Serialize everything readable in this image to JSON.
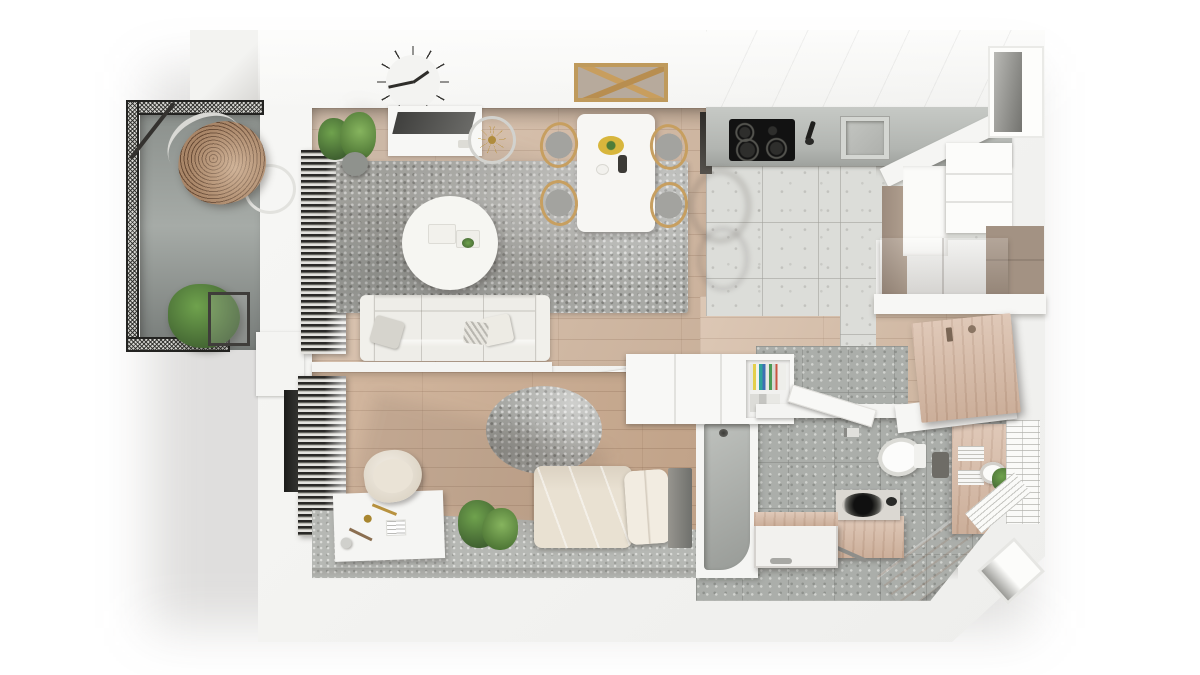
{
  "scene": {
    "title": "apartment-floor-plan-3d-render-top-view",
    "style": "photorealistic rendered floor plan, top-down, no visible text"
  },
  "palette": {
    "wall": "#f3f3f1",
    "wood": "#d6bda7",
    "wood2": "#cdae93",
    "woodfurn": "#d9bda9",
    "tile": "#dcddd9",
    "concrete": "#abaeaa",
    "carpet": "#b6b8b4",
    "rug": "#a8a9a5",
    "mesh": "#2b2b28",
    "taupe": "#a79685",
    "sofa": "#eeede8",
    "bedding": "#e9e1d2",
    "green": "#4f7d39",
    "gold": "#bf9a3f",
    "yellow": "#d8b63c",
    "dark": "#181816"
  },
  "rooms": [
    {
      "name": "balcony",
      "furniture": [
        "mesh railing",
        "hanging egg chair",
        "potted plant",
        "wire side table"
      ]
    },
    {
      "name": "living room",
      "furniture": [
        "wall clock",
        "tv console",
        "floor lamp",
        "potted plants",
        "shag rug",
        "round coffee table",
        "3-seat sofa",
        "window blinds with radiator"
      ]
    },
    {
      "name": "dining area",
      "furniture": [
        "white dining table",
        "4 wooden hoop chairs",
        "wooden pendant frame",
        "yellow plate",
        "dark bottle"
      ]
    },
    {
      "name": "kitchen",
      "furniture": [
        "gray countertop",
        "black induction cooktop",
        "sink with black faucet",
        "tall white cabinets",
        "taupe cabinets",
        "white shelf",
        "speckled tile floor",
        "wall niche"
      ]
    },
    {
      "name": "entry hall",
      "furniture": [
        "wooden entry door",
        "white console shelf",
        "wood floor"
      ]
    },
    {
      "name": "bathroom",
      "furniture": [
        "walk-in shower with drain",
        "wall-hung toilet",
        "toilet paper holder",
        "wood-clad washing machine",
        "white storage bench",
        "wood vanity with round basin",
        "towel shelves",
        "white wall tiles",
        "wall niche",
        "plant"
      ]
    },
    {
      "name": "bedroom",
      "furniture": [
        "single bed with cream duvet",
        "pillow",
        "dark headboard",
        "round shag rug",
        "white desk with lamp",
        "cream tub armchair",
        "potted plant",
        "window blinds",
        "gray carpet strip"
      ]
    },
    {
      "name": "hallway pass",
      "furniture": [
        "white wardrobe unit",
        "book spines shelf",
        "white interior doors"
      ]
    }
  ],
  "counts": {
    "dining_chairs": 4,
    "cooktop_burners": 4,
    "sofa_pillows": 3,
    "clock_ticks": 12,
    "book_spines": 9
  }
}
